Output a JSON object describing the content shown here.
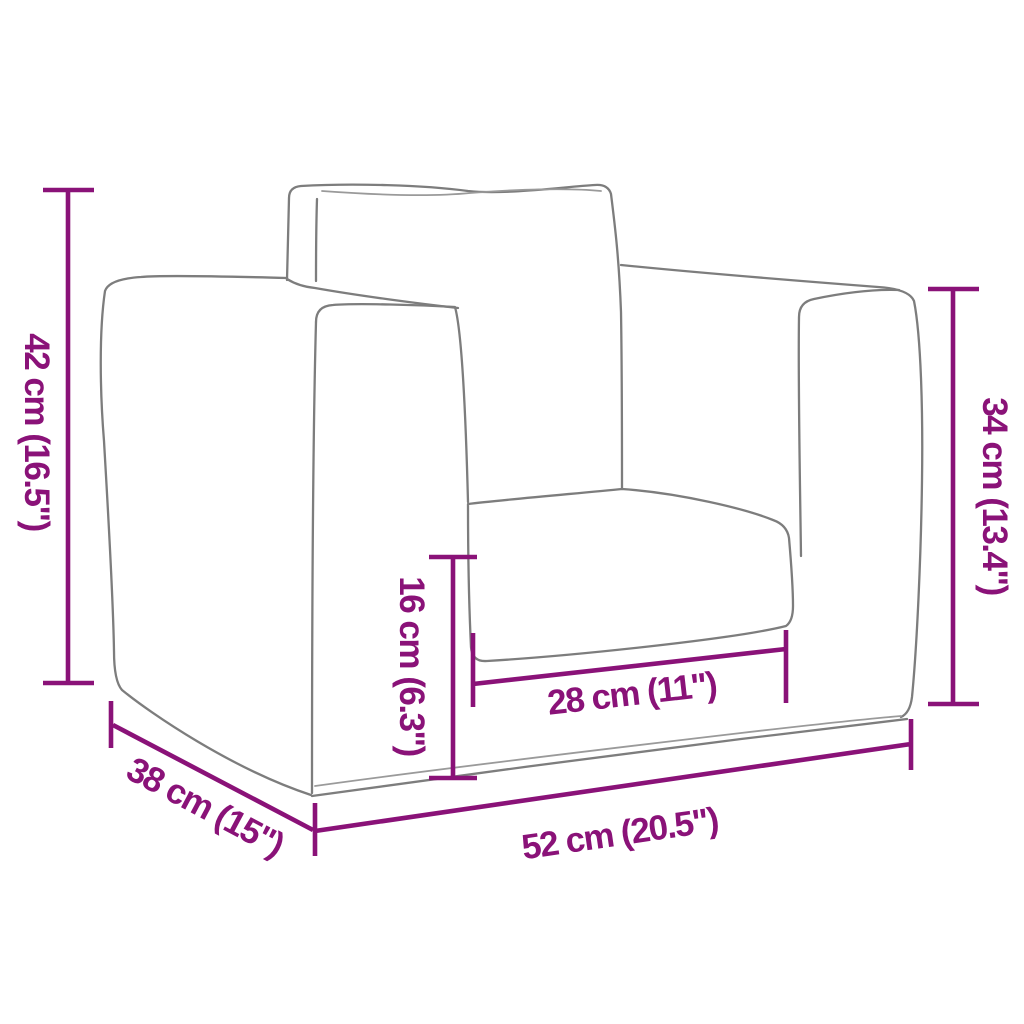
{
  "diagram": {
    "type": "product_dimension_diagram",
    "subject": "kids sofa armchair line drawing, three-quarter view",
    "background_color": "#ffffff",
    "outline_color": "#7d7d7d",
    "accent_color": "#8A1278"
  },
  "dimensions": [
    {
      "id": "overall_height",
      "label": "42 cm (16.5\")",
      "cm": 42,
      "inches": 16.5,
      "placement": "left-vertical"
    },
    {
      "id": "arm_height",
      "label": "34 cm (13.4\")",
      "cm": 34,
      "inches": 13.4,
      "placement": "right-vertical"
    },
    {
      "id": "seat_height",
      "label": "16 cm (6.3\")",
      "cm": 16,
      "inches": 6.3,
      "placement": "center-vertical"
    },
    {
      "id": "seat_width",
      "label": "28 cm (11\")",
      "cm": 28,
      "inches": 11,
      "placement": "seat-front-horizontal"
    },
    {
      "id": "overall_width",
      "label": "52 cm (20.5\")",
      "cm": 52,
      "inches": 20.5,
      "placement": "bottom-front-horizontal"
    },
    {
      "id": "depth",
      "label": "38 cm (15\")",
      "cm": 38,
      "inches": 15,
      "placement": "bottom-left-diagonal"
    }
  ]
}
